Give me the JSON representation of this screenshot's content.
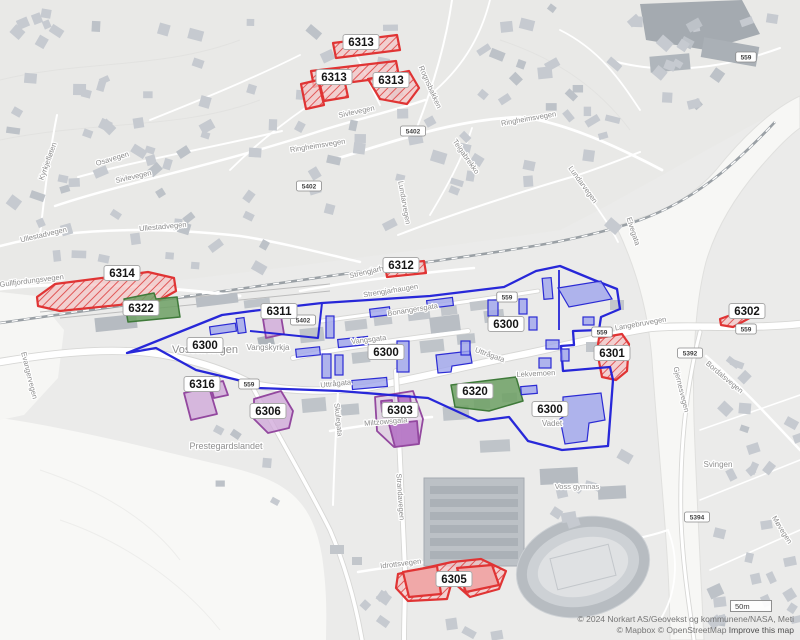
{
  "map": {
    "attribution_line1": "© 2024 Norkart AS/Geovekst og kommunene/NASA, Meti",
    "attribution_line2_prefix": "© Mapbox © OpenStreetMap",
    "attribution_link": "Improve this map",
    "scale_label": "50m",
    "colors": {
      "zone_red": "#e03434",
      "zone_blue": "#1d1dd8",
      "zone_green": "#3f7a3a",
      "zone_purple": "#93489f",
      "building": "#c6cad0",
      "background": "#ebebea"
    },
    "zone_labels": [
      {
        "id": "6313",
        "x": 361,
        "y": 42,
        "color": "red"
      },
      {
        "id": "6313",
        "x": 334,
        "y": 77,
        "color": "red"
      },
      {
        "id": "6313",
        "x": 391,
        "y": 80,
        "color": "red"
      },
      {
        "id": "6314",
        "x": 122,
        "y": 273,
        "color": "red"
      },
      {
        "id": "6312",
        "x": 401,
        "y": 265,
        "color": "red"
      },
      {
        "id": "6322",
        "x": 141,
        "y": 308,
        "color": "green"
      },
      {
        "id": "6311",
        "x": 279,
        "y": 311,
        "color": "purple"
      },
      {
        "id": "6300",
        "x": 205,
        "y": 345,
        "color": "blue"
      },
      {
        "id": "6300",
        "x": 386,
        "y": 352,
        "color": "blue"
      },
      {
        "id": "6300",
        "x": 506,
        "y": 324,
        "color": "blue"
      },
      {
        "id": "6300",
        "x": 550,
        "y": 409,
        "color": "blue"
      },
      {
        "id": "6302",
        "x": 747,
        "y": 311,
        "color": "red"
      },
      {
        "id": "6301",
        "x": 612,
        "y": 353,
        "color": "red"
      },
      {
        "id": "6316",
        "x": 202,
        "y": 384,
        "color": "purple"
      },
      {
        "id": "6306",
        "x": 268,
        "y": 411,
        "color": "purple"
      },
      {
        "id": "6320",
        "x": 475,
        "y": 391,
        "color": "green"
      },
      {
        "id": "6303",
        "x": 400,
        "y": 410,
        "color": "purple"
      },
      {
        "id": "6305",
        "x": 454,
        "y": 579,
        "color": "red"
      }
    ],
    "road_shields": [
      {
        "ref": "5402",
        "x": 413,
        "y": 131
      },
      {
        "ref": "5402",
        "x": 309,
        "y": 186
      },
      {
        "ref": "5402",
        "x": 303,
        "y": 320
      },
      {
        "ref": "559",
        "x": 249,
        "y": 384
      },
      {
        "ref": "559",
        "x": 507,
        "y": 297
      },
      {
        "ref": "559",
        "x": 602,
        "y": 332
      },
      {
        "ref": "559",
        "x": 746,
        "y": 329
      },
      {
        "ref": "559",
        "x": 746,
        "y": 57
      },
      {
        "ref": "5392",
        "x": 690,
        "y": 353
      },
      {
        "ref": "5394",
        "x": 697,
        "y": 517
      }
    ],
    "street_labels": [
      {
        "name": "Kyrkjefløten",
        "x": 50,
        "y": 162,
        "rot": -70
      },
      {
        "name": "Osavegen",
        "x": 113,
        "y": 161,
        "rot": -17
      },
      {
        "name": "Sivlevegen",
        "x": 134,
        "y": 179,
        "rot": -13
      },
      {
        "name": "Sivlevegen",
        "x": 357,
        "y": 114,
        "rot": -12
      },
      {
        "name": "Ullestadvegen",
        "x": 44,
        "y": 237,
        "rot": -13
      },
      {
        "name": "Ullestadvegen",
        "x": 163,
        "y": 229,
        "rot": -5
      },
      {
        "name": "Gullfjordungsvegen",
        "x": 32,
        "y": 283,
        "rot": -7
      },
      {
        "name": "Rognsbakken",
        "x": 428,
        "y": 88,
        "rot": 66
      },
      {
        "name": "Ringheimsvegen",
        "x": 318,
        "y": 148,
        "rot": -9
      },
      {
        "name": "Ringheimsvegen",
        "x": 529,
        "y": 121,
        "rot": -10
      },
      {
        "name": "Teigabrekko",
        "x": 464,
        "y": 158,
        "rot": 55
      },
      {
        "name": "Lundarvegen",
        "x": 402,
        "y": 203,
        "rot": 80
      },
      {
        "name": "Lundarvegen",
        "x": 581,
        "y": 186,
        "rot": 54
      },
      {
        "name": "Elvegata",
        "x": 631,
        "y": 232,
        "rot": 72
      },
      {
        "name": "Strengjarhaugen",
        "x": 377,
        "y": 272,
        "rot": -13
      },
      {
        "name": "Strengjarhaugen",
        "x": 391,
        "y": 293,
        "rot": -9
      },
      {
        "name": "Bonangersgata",
        "x": 413,
        "y": 312,
        "rot": -9
      },
      {
        "name": "Vangsgata",
        "x": 369,
        "y": 342,
        "rot": -7
      },
      {
        "name": "Uttrågata",
        "x": 336,
        "y": 386,
        "rot": -6
      },
      {
        "name": "Uttrågata",
        "x": 489,
        "y": 357,
        "rot": 20
      },
      {
        "name": "Miltzowsgata",
        "x": 386,
        "y": 424,
        "rot": -5
      },
      {
        "name": "Skulegata",
        "x": 336,
        "y": 420,
        "rot": 84
      },
      {
        "name": "Strandavegen",
        "x": 398,
        "y": 497,
        "rot": 86
      },
      {
        "name": "Idrottsvegen",
        "x": 401,
        "y": 566,
        "rot": -7
      },
      {
        "name": "Lekvemoen",
        "x": 536,
        "y": 376,
        "rot": -3
      },
      {
        "name": "Langebruvegen",
        "x": 641,
        "y": 326,
        "rot": -10
      },
      {
        "name": "Gjernesvegen",
        "x": 679,
        "y": 390,
        "rot": 76
      },
      {
        "name": "Bordalsvegen",
        "x": 723,
        "y": 379,
        "rot": 40
      },
      {
        "name": "Møvegen",
        "x": 780,
        "y": 531,
        "rot": 58
      },
      {
        "name": "Evangervegen",
        "x": 27,
        "y": 376,
        "rot": 76
      }
    ],
    "place_labels": [
      {
        "name": "Vossavangen",
        "x": 205,
        "y": 353,
        "size": 11
      },
      {
        "name": "Vangskyrkja",
        "x": 268,
        "y": 350,
        "size": 8
      },
      {
        "name": "Prestegardslandet",
        "x": 226,
        "y": 449,
        "size": 9
      },
      {
        "name": "Vadet",
        "x": 552,
        "y": 426,
        "size": 8
      },
      {
        "name": "Svingen",
        "x": 718,
        "y": 467,
        "size": 8
      },
      {
        "name": "Voss gymnas",
        "x": 577,
        "y": 489,
        "size": 7.5
      }
    ]
  }
}
